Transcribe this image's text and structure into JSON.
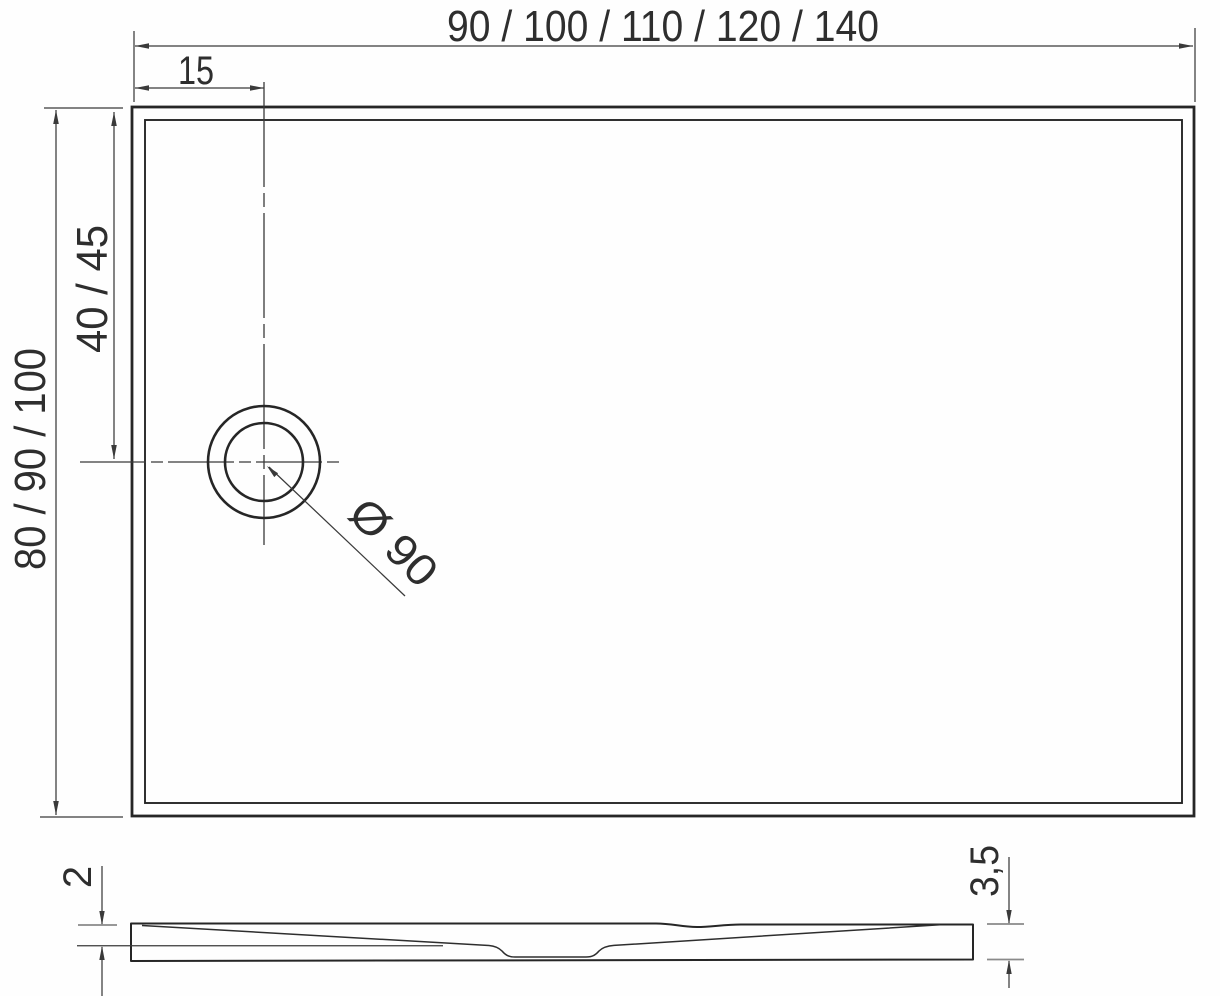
{
  "colors": {
    "background": "#fefefe",
    "outline": "#262626",
    "dimension_lines": "#3a3a3a",
    "extension_ticks": "#8a8a8a",
    "text": "#2e2e2e"
  },
  "top_view": {
    "width_dimension_label": "90 / 100 / 110 / 120 / 140",
    "drain_offset_left_label": "15",
    "depth_dimension_label": "80 / 90 / 100",
    "drain_offset_top_label": "40 / 45",
    "drain_diameter_label": "Ø 90"
  },
  "side_view": {
    "rim_thickness_label": "2",
    "overall_height_label": "3,5"
  }
}
